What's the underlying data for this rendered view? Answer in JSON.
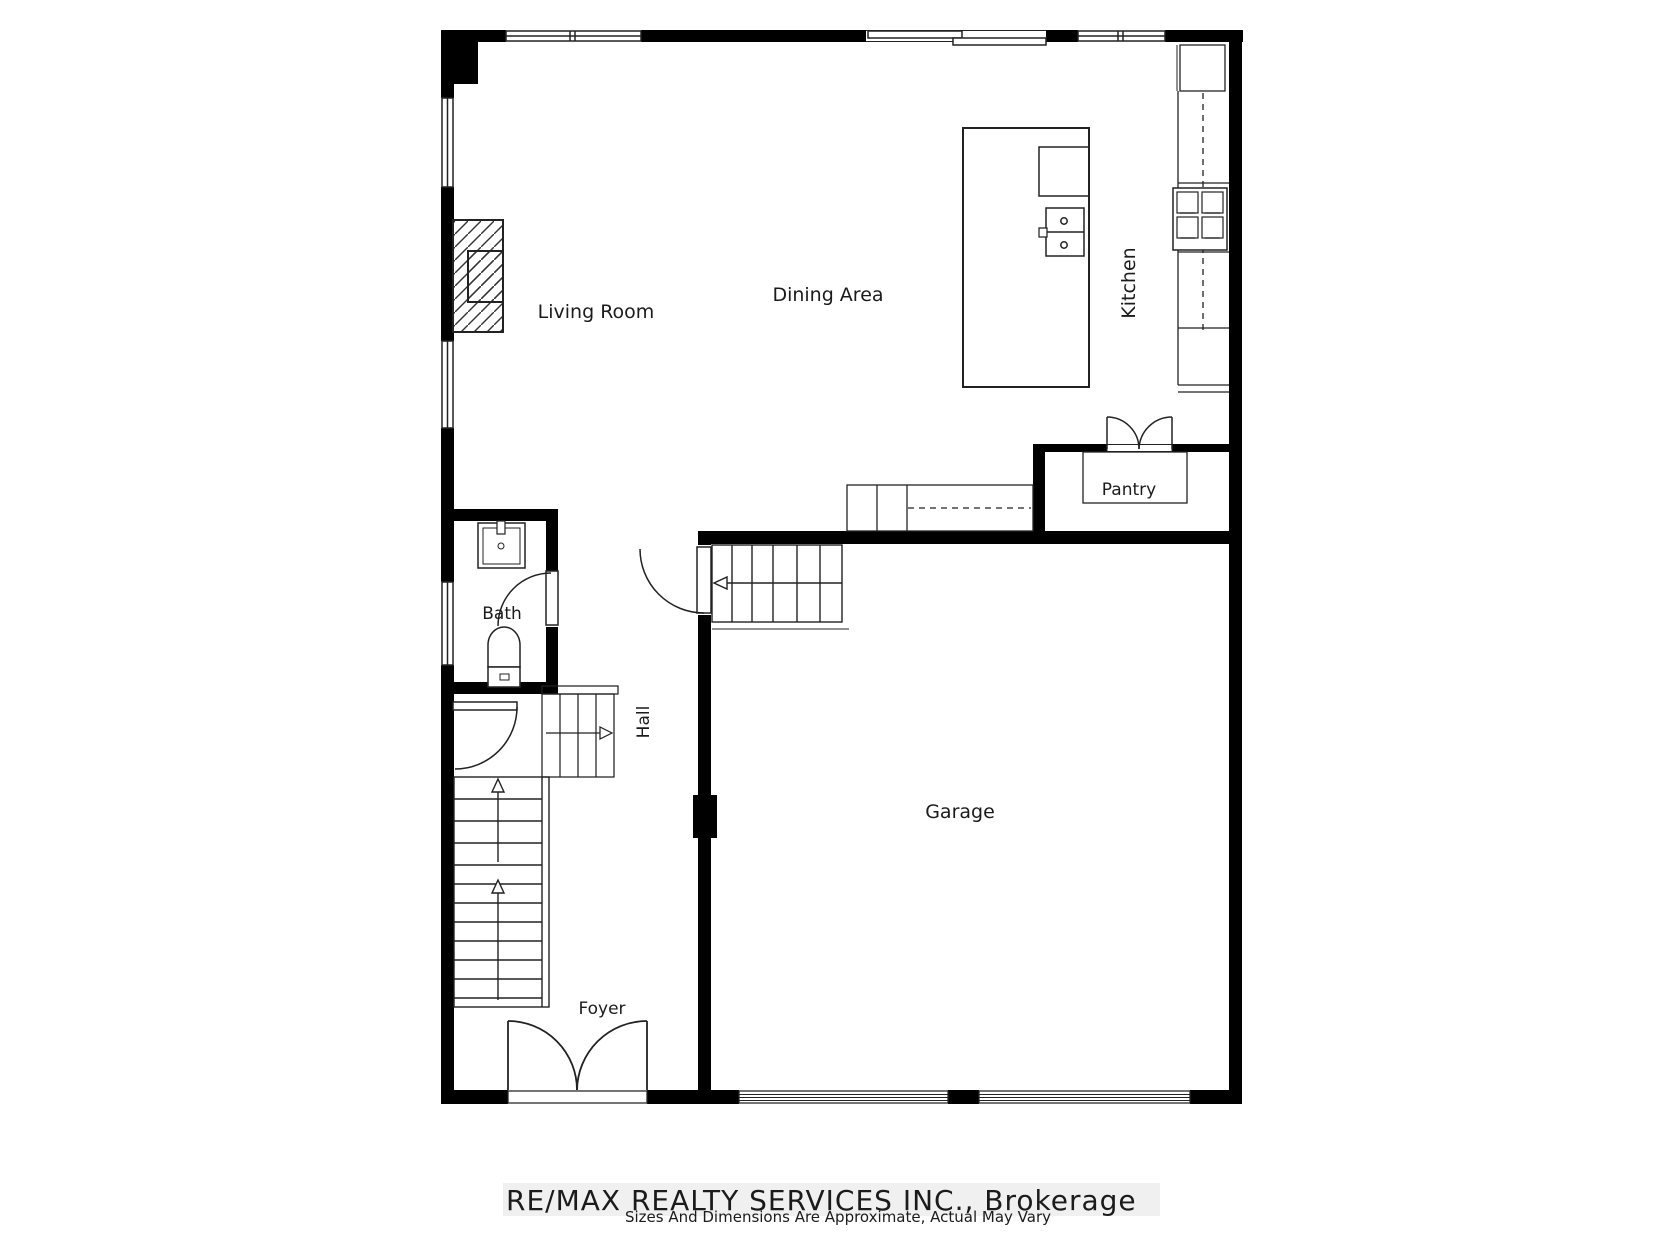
{
  "plan": {
    "labels": {
      "living_room": "Living Room",
      "dining_area": "Dining Area",
      "kitchen": "Kitchen",
      "pantry": "Pantry",
      "bath": "Bath",
      "hall": "Hall",
      "garage": "Garage",
      "foyer": "Foyer"
    }
  },
  "footer": {
    "watermark": "RE/MAX REALTY SERVICES INC., Brokerage",
    "disclaimer": "Sizes And Dimensions Are Approximate, Actual May Vary"
  },
  "colors": {
    "wall": "#000000",
    "line": "#222222",
    "watermark_bg": "#f0f0f0",
    "watermark_text": "#d8d8d8",
    "label_text": "#1b1b1b"
  }
}
